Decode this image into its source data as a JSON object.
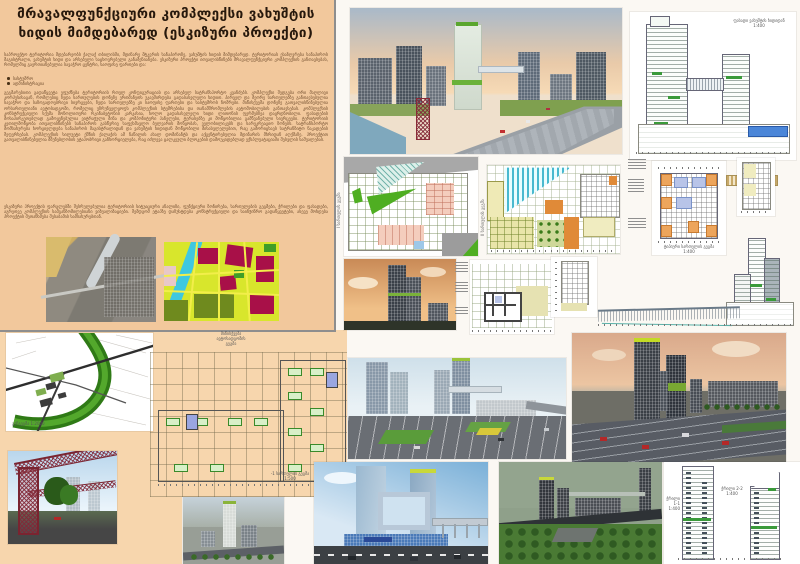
{
  "poster": {
    "title_line1": "მრავალფუნქციური კომპლექსი ვახუშტის",
    "title_line2": "ხიდის მიმდებარედ (ესკიზური პროექტი)",
    "intro": "საპროექტო ტერიტორია მდებარეობს ქალაქ თბილისში, მდინარე მტკვრის სანაპიროზე, ვახუშტის ხიდის მიმდებარედ. ტერიტორიას ესაზღვრება სანაპიროს მაგისტრალი, ვახუშტის ხიდი და არსებული საცხოვრებელი განაშენიანება. ესკიზური პროექტი ითვალისწინებს მრავალფუნქციური კომპლექსის განთავსებას, რომელშიც გაერთიანებულია სავაჭრო ცენტრი, საოფისე ფართები და:",
    "bullets": [
      "სასტუმრო",
      "ადმინისტრაცია"
    ],
    "body_main": "გეგმარებითი გადაწყვეტა ეფუძნება ტერიტორიის რთულ კონფიგურაციას და არსებულ სატრანსპორტო კვანძებს. კომპლექსი შედგება ორი მაღლივი კორპუსისაგან, რომლებიც ზედა სართულების დონეზე ერთმანეთს უკავშირდება გადასასვლელი ხიდით. პირველ და მეორე სართულებზე განთავსებულია სავაჭრო და საზოგადოებრივი სივრცეები, ზედა სართულებზე კი საოფისე ფართები და სასტუმროს ნომრები. მიწისქვეშა დონეზე გათვალისწინებულია ორსართულიანი ავტოსადგომი, რომელიც უზრუნველყოფს კომპლექსის სტუმრებისა და თანამშრომლების ავტომობილების განთავსებას. კომპლექსის კონსტრუქციული სქემა მონოლითური რკინაბეტონის კარკასია, ხოლო გადასასვლელი ხიდი ლითონის ფერმებზეა დაყრდნობილი. ფასადების მოსაპირკეთებლად გამოყენებულია ვიტრაჟული მინა და კომპოზიტური პანელები, ტერასებზე კი მოწყობილია გამწვანებული სივრცეები. ტერიტორიის კეთილმოწყობა ითვალისწინებს სანაპიროს გასწვრივ საფეხმავლო ბულვარის მოწყობას, ველობილიკებს და სარეკრეაციო ზონებს. სატრანსპორტო მომსახურება ხორციელდება სანაპიროს მაგისტრალიდან და ვახუშტის ხიდიდან მოწყობილი მისასვლელებით, რაც გამორიცხავს სატრანზიტო ნაკადების შეფერხებას. კომპლექსის სილუეტი ქმნის ქალაქის ამ ნაწილის ახალ დომინანტს და აქცენტირებულია მდინარის მხრიდან აღქმაზე. პროექტით გათვალისწინებულია მშენებლობის ეტაპობრივი განხორციელება, რაც იძლევა ცალკეული ბლოკების დამოუკიდებლად ექსპლუატაციაში შესვლის საშუალებას.",
    "body_second": "ესკიზური პროექტის ფარგლებში შესრულებულია ტერიტორიის სიტუაციური ანალიზი, ფუნქციური ზონირება, სართულების გეგმები, ჭრილები და ფასადები, აგრეთვე კომპლექსის სამგანზომილებიანი ვიზუალიზაციები. შემდგომ ეტაპზე დაზუსტდება კონსტრუქციული და საინჟინრო გადაწყვეტები, ასევე მოხდება პროექტის შეთანხმება შესაბამის სამსახურებთან.",
    "captions": {
      "facade": "ფასადი ვახუშტის ხიდიდან",
      "facade_scale": "1:400",
      "plan1_side": "I სართულის გეგმა",
      "plan2_side": "II სართულის გეგმა",
      "typical": "ტიპიური სართულის გეგმა",
      "typical_scale": "1:400",
      "parking_l1": "მიწისქვეშა",
      "parking_l2": "ავტოსადგომის",
      "parking_l3": "გეგმა",
      "minus1": "-1 სართულის გეგმა",
      "minus1_scale": "1:500",
      "site": "გენგეგმა 1:2000",
      "section1": "ჭრილი 1-1",
      "section2": "ჭრილი 2-2",
      "section_scale": "1:400"
    },
    "colors": {
      "panel_peach": "#f2c89c",
      "page_peach": "#f7d6ad",
      "accent_green": "#4fae22",
      "zoning_yellow": "#d8e62c",
      "zoning_crimson": "#a81048",
      "river_cyan": "#3ec8e0"
    }
  }
}
